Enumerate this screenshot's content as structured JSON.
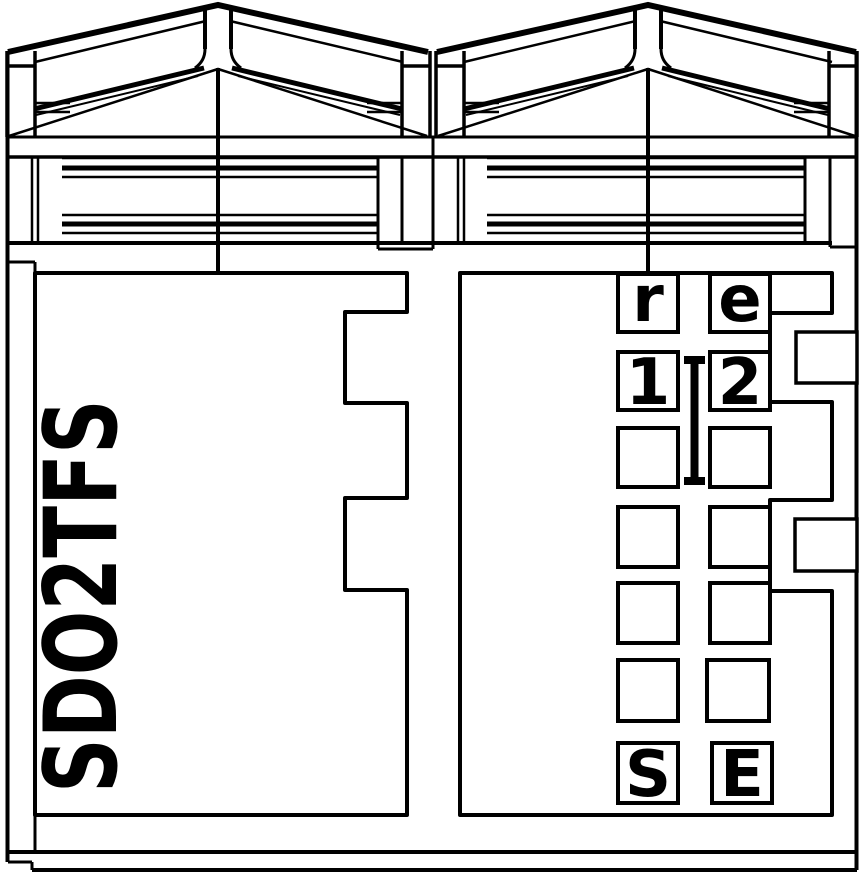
{
  "device": {
    "side_label": "SDO2TFS",
    "terminals": {
      "top_row": {
        "left": "r",
        "right": "e"
      },
      "second_row": {
        "left": "1",
        "right": "2"
      },
      "bottom_row": {
        "left": "S",
        "right": "E"
      }
    }
  },
  "colors": {
    "line": "#000000",
    "background": "#ffffff"
  }
}
